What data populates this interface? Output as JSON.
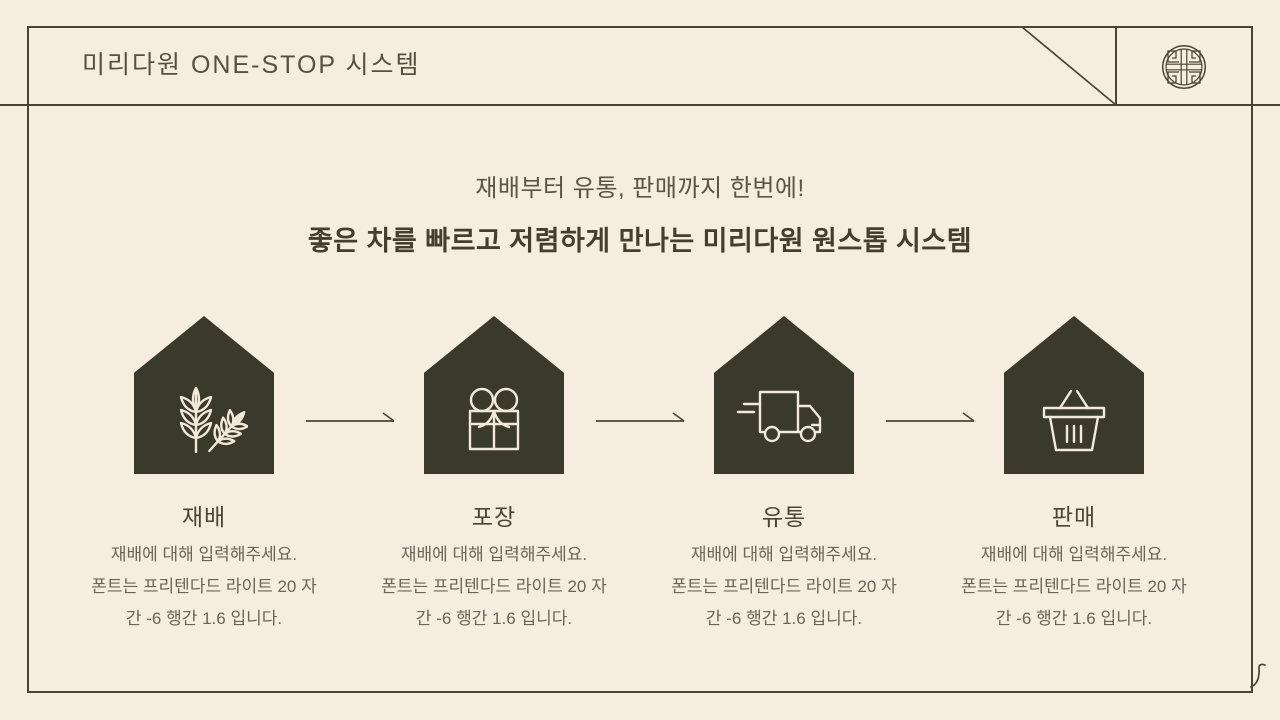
{
  "header": {
    "title": "미리다원 ONE-STOP 시스템",
    "emblem_icon": "traditional-medallion-icon"
  },
  "intro": {
    "line1": "재배부터 유통, 판매까지 한번에!",
    "line2": "좋은 차를 빠르고 저렴하게 만나는 미리다원 원스톱 시스템"
  },
  "steps": [
    {
      "label": "재배",
      "icon": "wheat-icon",
      "desc_lines": [
        "재배에 대해 입력해주세요.",
        "폰트는 프리텐다드 라이트 20 자",
        "간 -6 행간 1.6 입니다."
      ]
    },
    {
      "label": "포장",
      "icon": "gift-icon",
      "desc_lines": [
        "재배에 대해 입력해주세요.",
        "폰트는 프리텐다드 라이트 20 자",
        "간 -6 행간 1.6 입니다."
      ]
    },
    {
      "label": "유통",
      "icon": "delivery-truck-icon",
      "desc_lines": [
        "재배에 대해 입력해주세요.",
        "폰트는 프리텐다드 라이트 20 자",
        "간 -6 행간 1.6 입니다."
      ]
    },
    {
      "label": "판매",
      "icon": "shopping-basket-icon",
      "desc_lines": [
        "재배에 대해 입력해주세요.",
        "폰트는 프리텐다드 라이트 20 자",
        "간 -6 행간 1.6 입니다."
      ]
    }
  ],
  "colors": {
    "background": "#f5ede0",
    "line": "#4a4437",
    "house_fill": "#3b392c",
    "icon_stroke": "#f1e9da",
    "title_text": "#56503f",
    "headline_bold": "#443e2e",
    "body_text": "#6b6457"
  }
}
